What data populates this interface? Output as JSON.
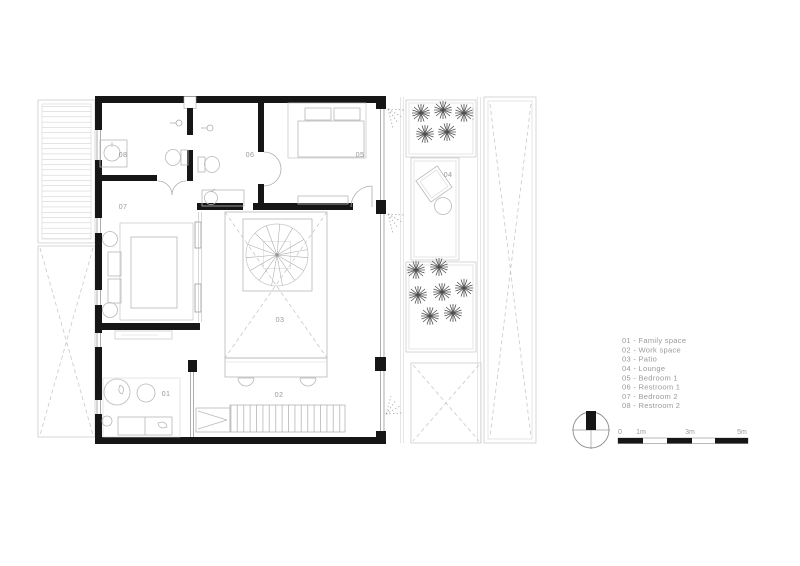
{
  "plan": {
    "room_labels": {
      "family": "01",
      "work": "02",
      "patio": "03",
      "lounge": "04",
      "bedroom1": "05",
      "restroom1": "06",
      "bedroom2": "07",
      "restroom2": "08"
    }
  },
  "legend": {
    "items": [
      {
        "text": "01 - Family space"
      },
      {
        "text": "02 - Work space"
      },
      {
        "text": "03 - Patio"
      },
      {
        "text": "04 - Lounge"
      },
      {
        "text": "05 - Bedroom 1"
      },
      {
        "text": "06 - Restroom 1"
      },
      {
        "text": "07 - Bedroom 2"
      },
      {
        "text": "08 - Restroom 2"
      }
    ]
  },
  "scale_bar": {
    "labels": [
      "0",
      "1m",
      "3m",
      "5m"
    ]
  },
  "colors": {
    "wall": "#161616",
    "furniture_line": "#b8b8b8",
    "dashed_line": "#c9c9c9",
    "label_text": "#9a9a9a",
    "plant": "#4f4f4f",
    "background": "#ffffff"
  }
}
